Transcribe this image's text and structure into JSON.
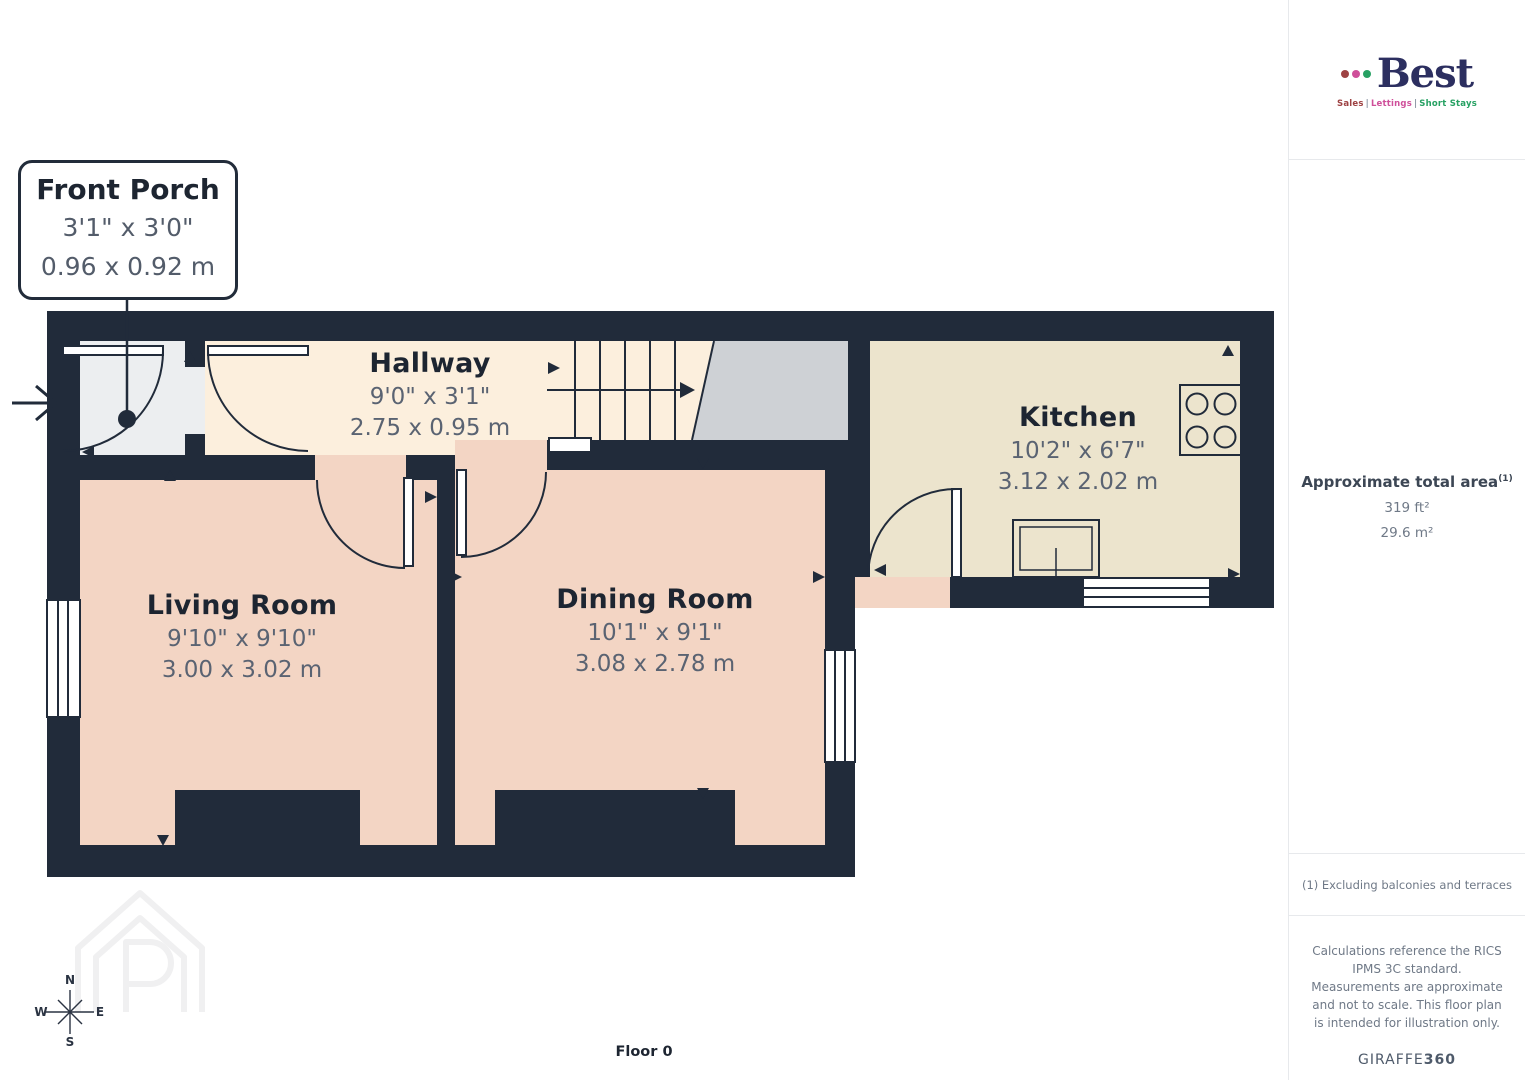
{
  "colors": {
    "wall": "#212b3a",
    "porch_floor": "#eceef0",
    "hallway_floor": "#fcefdd",
    "kitchen_floor": "#ece4cd",
    "room_floor_pink": "#f3d5c4",
    "landing_gray": "#ced1d5",
    "label_title": "#1d2531",
    "label_dim": "#5a6372",
    "brand_navy": "#2c2f60",
    "brand_red": "#9e4243",
    "brand_pink": "#cf4f9a",
    "brand_green": "#27a163"
  },
  "callout": {
    "title": "Front Porch",
    "imperial": "3'1\" x 3'0\"",
    "metric": "0.96 x 0.92 m"
  },
  "rooms": [
    {
      "name": "Hallway",
      "imperial": "9'0\" x 3'1\"",
      "metric": "2.75 x 0.95 m"
    },
    {
      "name": "Kitchen",
      "imperial": "10'2\" x 6'7\"",
      "metric": "3.12 x 2.02 m"
    },
    {
      "name": "Living Room",
      "imperial": "9'10\" x 9'10\"",
      "metric": "3.00 x 3.02 m"
    },
    {
      "name": "Dining Room",
      "imperial": "10'1\" x 9'1\"",
      "metric": "3.08 x 2.78 m"
    }
  ],
  "floor_label": "Floor 0",
  "compass": {
    "n": "N",
    "e": "E",
    "s": "S",
    "w": "W"
  },
  "sidebar": {
    "brand": {
      "name": "Best",
      "tagline": {
        "sales": "Sales",
        "lettings": "Lettings",
        "short_stays": "Short Stays",
        "separator": "|"
      }
    },
    "area": {
      "label": "Approximate total area",
      "marker": "(1)",
      "imperial": "319 ft²",
      "metric": "29.6 m²"
    },
    "footnote": "(1) Excluding balconies and terraces",
    "disclaimer": "Calculations reference the RICS IPMS 3C standard. Measurements are approximate and not to scale. This floor plan is intended for illustration only.",
    "credit": {
      "brand": "GIRAFFE",
      "suffix": "360"
    }
  }
}
